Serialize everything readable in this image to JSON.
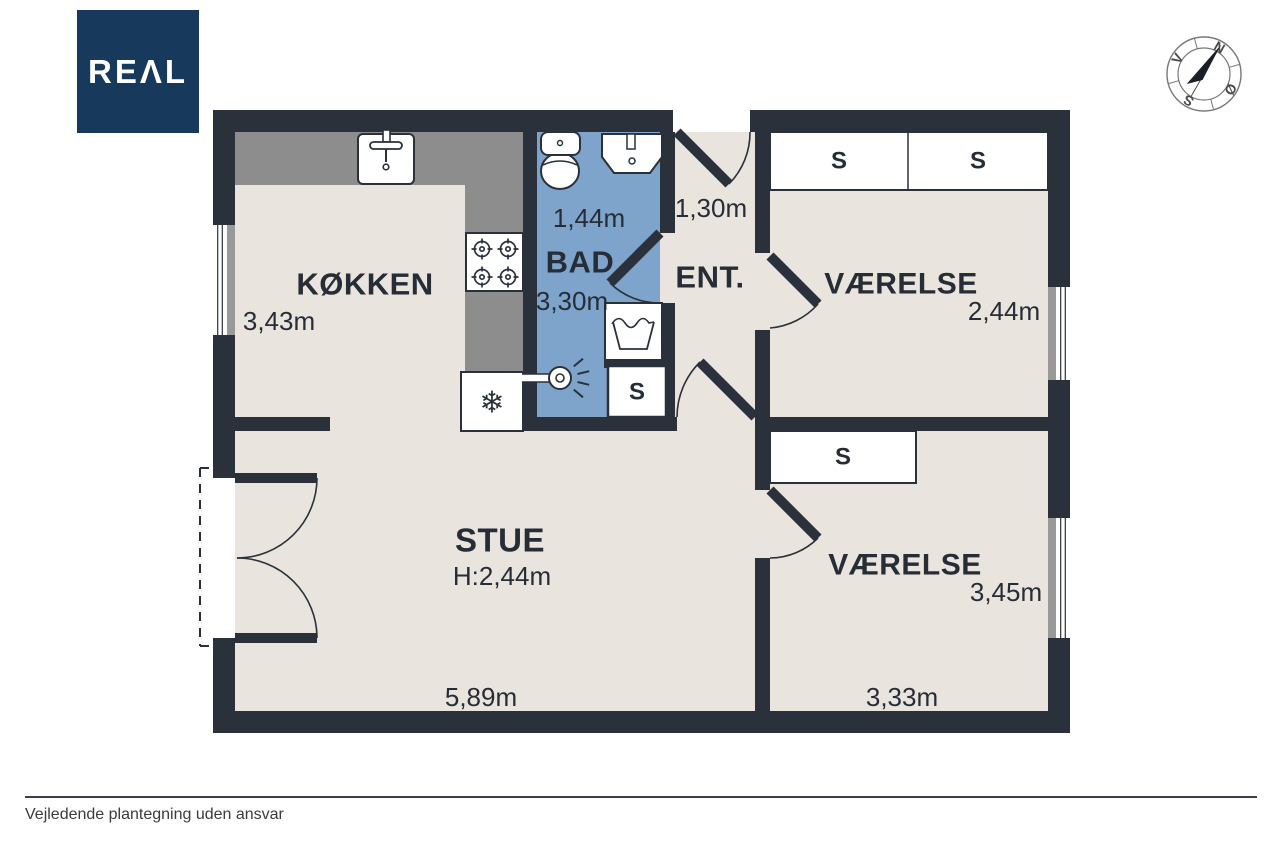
{
  "logo": {
    "text": "REΛL",
    "background_color": "#17395C"
  },
  "compass": {
    "labels": {
      "north": "N",
      "west": "V",
      "south": "S",
      "east": "Ø"
    }
  },
  "floorplan": {
    "rooms": {
      "kokken": {
        "label": "KØKKEN",
        "width": "3,43m"
      },
      "bad": {
        "label": "BAD",
        "width": "1,44m",
        "length": "3,30m"
      },
      "ent": {
        "label": "ENT.",
        "width": "1,30m"
      },
      "vaerelse_top": {
        "label": "VÆRELSE",
        "width": "2,44m"
      },
      "vaerelse_bottom": {
        "label": "VÆRELSE",
        "width": "3,45m",
        "length": "3,33m"
      },
      "stue": {
        "label": "STUE",
        "ceiling_height": "H:2,44m",
        "length": "5,89m"
      }
    },
    "closet_label": "S",
    "icons": {
      "freezer": "❄"
    },
    "colors": {
      "wall": "#2A313B",
      "floor": "#EAE4DE",
      "bathroom_floor": "#7FA4CB",
      "counter": "#8D8D8D",
      "window_sill": "#999999",
      "logo_navy": "#17395C"
    }
  },
  "footer": {
    "disclaimer": "Vejledende plantegning uden ansvar"
  }
}
